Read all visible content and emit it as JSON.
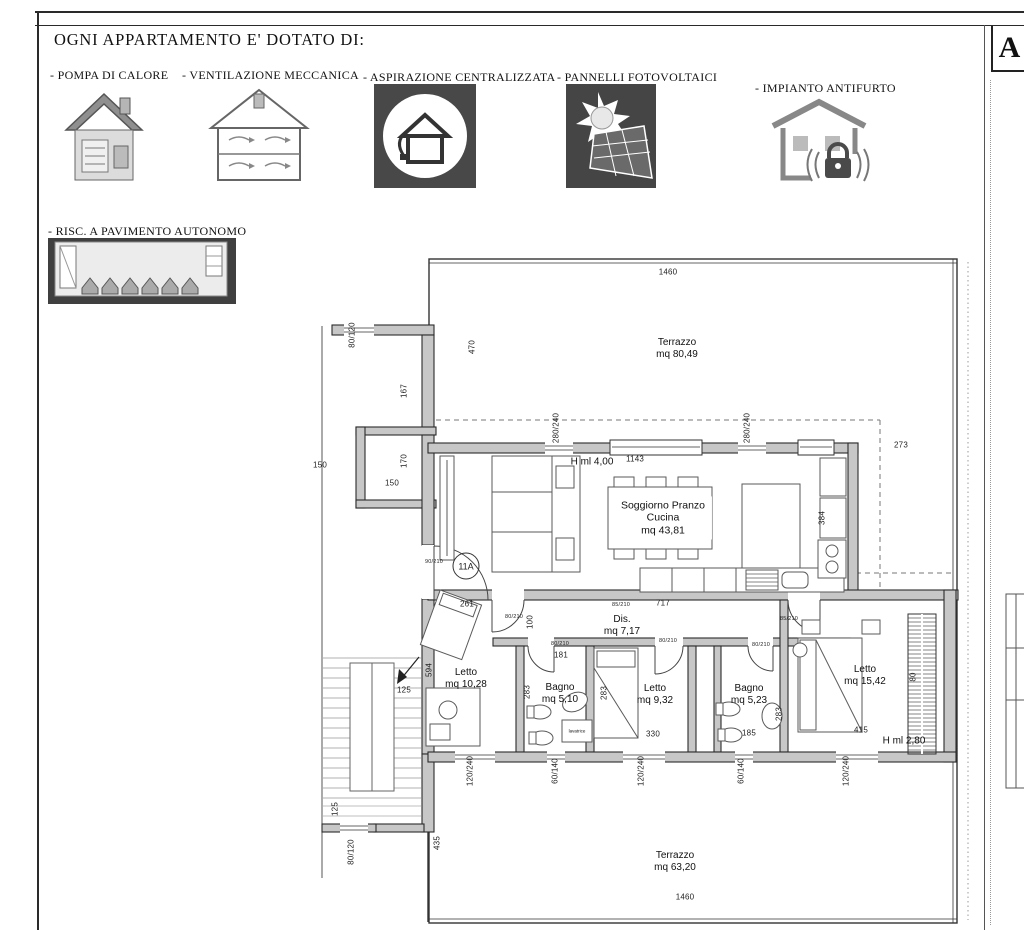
{
  "header": {
    "title": "OGNI APPARTAMENTO E' DOTATO DI:",
    "corner_letter": "A",
    "amenities": [
      {
        "label": "- POMPA DI CALORE",
        "icon": "heat-pump-icon"
      },
      {
        "label": "- VENTILAZIONE MECCANICA",
        "icon": "mechanical-ventilation-icon"
      },
      {
        "label": "- ASPIRAZIONE CENTRALIZZATA",
        "icon": "central-vacuum-icon"
      },
      {
        "label": "- PANNELLI FOTOVOLTAICI",
        "icon": "solar-panels-icon"
      },
      {
        "label": "- IMPIANTO ANTIFURTO",
        "icon": "burglar-alarm-icon"
      },
      {
        "label": "- RISC. A PAVIMENTO AUTONOMO",
        "icon": "floor-heating-icon"
      }
    ]
  },
  "plan": {
    "apartment_id": "11A",
    "rooms": {
      "terrazzo_top": {
        "name": "Terrazzo",
        "area": "mq 80,49"
      },
      "soggiorno": {
        "line1": "Soggiorno Pranzo",
        "line2": "Cucina",
        "area": "mq 43,81"
      },
      "dis": {
        "name": "Dis.",
        "area": "mq 7,17"
      },
      "letto1": {
        "name": "Letto",
        "area": "mq 10,28"
      },
      "bagno1": {
        "name": "Bagno",
        "area": "mq 5,10"
      },
      "letto2": {
        "name": "Letto",
        "area": "mq 9,32"
      },
      "bagno2": {
        "name": "Bagno",
        "area": "mq 5,23"
      },
      "letto3": {
        "name": "Letto",
        "area": "mq 15,42"
      },
      "terrazzo_bottom": {
        "name": "Terrazzo",
        "area": "mq 63,20"
      }
    },
    "notes": {
      "ceiling_height_living": "H ml 4,00",
      "ceiling_height_bedroom": "H ml 2,80",
      "washer": "lavatrice"
    },
    "dims": [
      "1460",
      "470",
      "80/120",
      "167",
      "150",
      "170",
      "150",
      "280/240",
      "280/240",
      "1143",
      "273",
      "384",
      "90/210",
      "717",
      "85/210",
      "261",
      "80/210",
      "100",
      "80/210",
      "181",
      "594",
      "283",
      "80/210",
      "283",
      "330",
      "80/210",
      "185",
      "283",
      "85/210",
      "415",
      "80",
      "120/240",
      "60/140",
      "120/240",
      "60/140",
      "120/240",
      "125",
      "125",
      "80/120",
      "435",
      "1460"
    ]
  }
}
